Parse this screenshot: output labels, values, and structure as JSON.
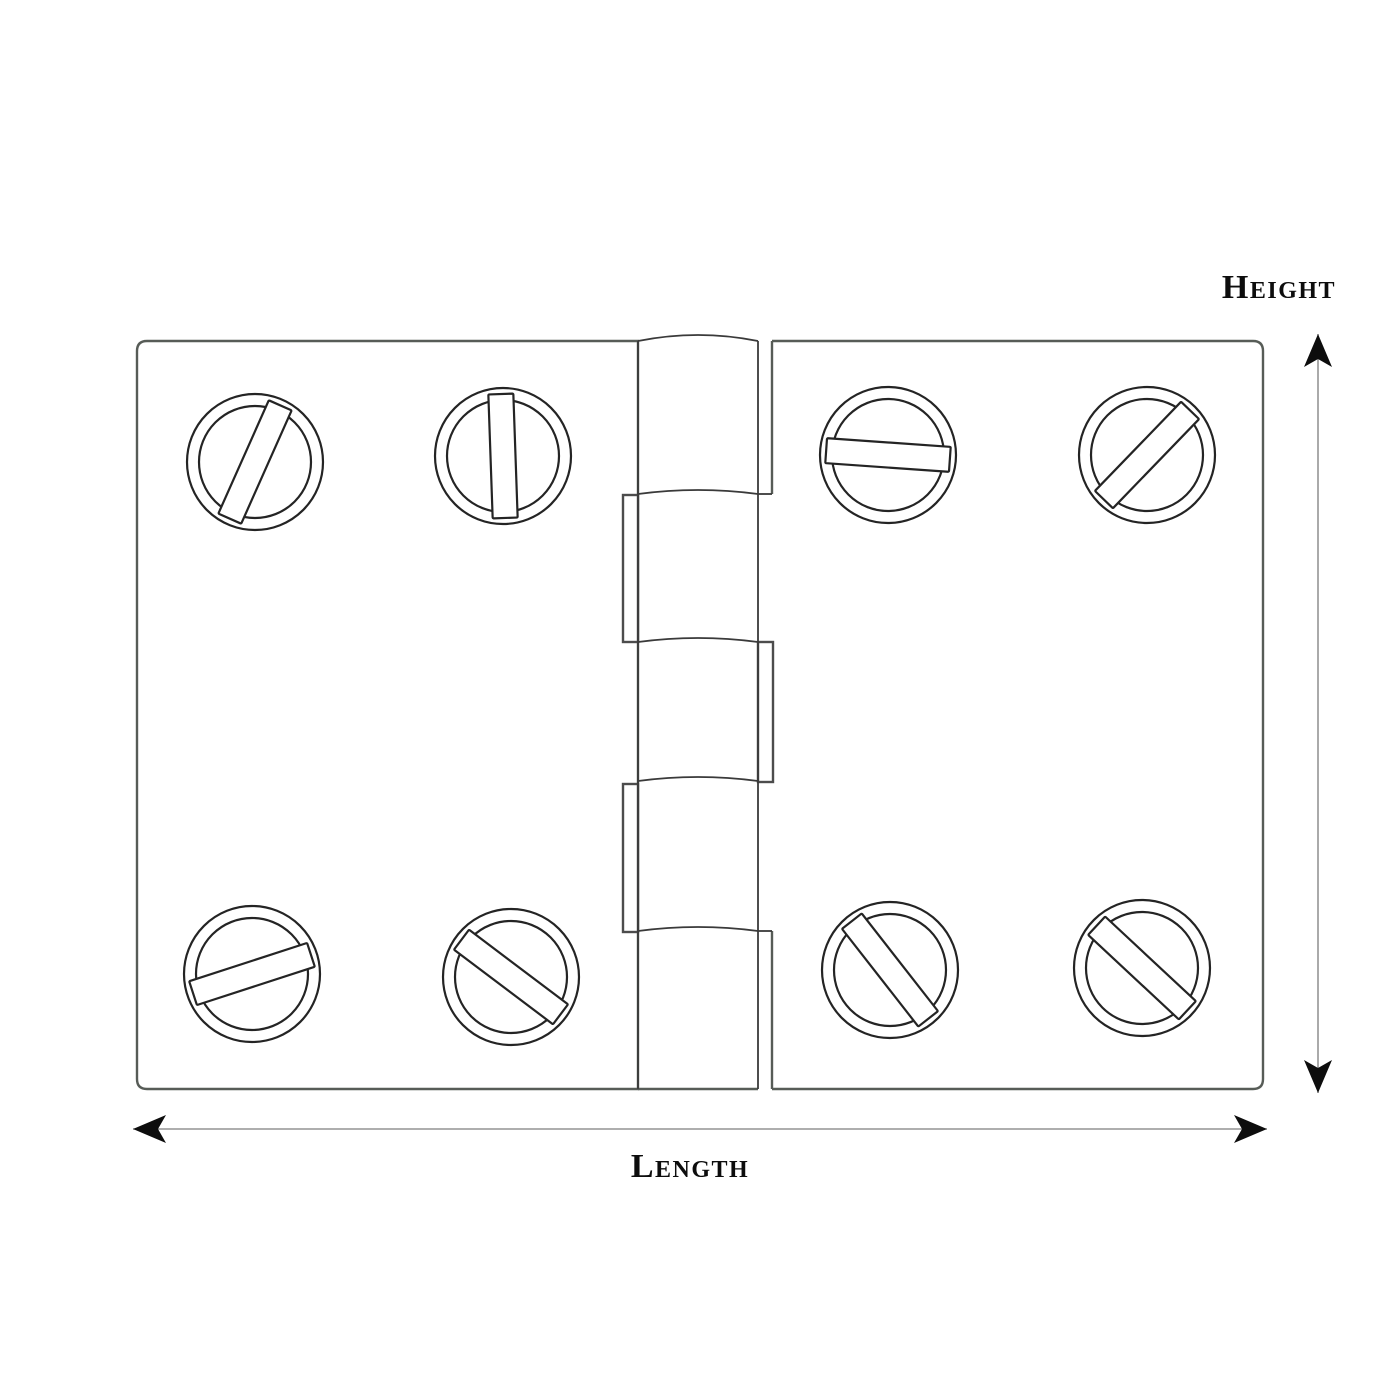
{
  "labels": {
    "height": "Height",
    "length": "Length"
  },
  "colors": {
    "background": "#ffffff",
    "plate_stroke": "#575c57",
    "barrel_stroke": "#3a3a3a",
    "tab_stroke": "#4c4c4c",
    "screw_stroke": "#242424",
    "dim_line": "#7d7d7d",
    "arrow_fill": "#0d0d0d",
    "text": "#0d0d0d",
    "fill": "#ffffff"
  },
  "diagram": {
    "canvas": {
      "w": 1400,
      "h": 1400
    },
    "left_plate": {
      "x1": 137,
      "y1": 341,
      "x2": 638,
      "y2": 1089,
      "corner_r": 10
    },
    "right_plate": {
      "x1": 772,
      "y1": 341,
      "x2": 1263,
      "y2": 1089,
      "corner_r": 10,
      "left_edge_segments": [
        [
          341,
          494
        ],
        [
          931,
          1089
        ]
      ],
      "step_connectors_y": [
        494,
        931
      ]
    },
    "barrel": {
      "x1": 638,
      "x2": 758,
      "top": 341,
      "bottom": 1089,
      "top_arch_ctrl_rise": 12,
      "joints": [
        494,
        642,
        781,
        931
      ],
      "joint_ctrl_rise": 8,
      "tabs": [
        {
          "x": 623,
          "y": 495,
          "w": 15,
          "h": 147
        },
        {
          "x": 623,
          "y": 784,
          "w": 15,
          "h": 148
        },
        {
          "x": 758,
          "y": 642,
          "w": 15,
          "h": 140
        }
      ]
    },
    "screws": {
      "outer_r": 68,
      "inner_r": 56,
      "slot_length": 124,
      "slot_width": 25,
      "items": [
        {
          "x": 255,
          "y": 462,
          "angle": 66
        },
        {
          "x": 503,
          "y": 456,
          "angle": 92
        },
        {
          "x": 888,
          "y": 455,
          "angle": -4
        },
        {
          "x": 1147,
          "y": 455,
          "angle": 46
        },
        {
          "x": 252,
          "y": 974,
          "angle": 18
        },
        {
          "x": 511,
          "y": 977,
          "angle": -37
        },
        {
          "x": 890,
          "y": 970,
          "angle": -52
        },
        {
          "x": 1142,
          "y": 968,
          "angle": -43
        }
      ]
    },
    "dimensions": {
      "length": {
        "y": 1129,
        "x1": 133,
        "x2": 1267,
        "label_x": 690,
        "label_y": 1177
      },
      "height": {
        "x": 1318,
        "y1": 334,
        "y2": 1093,
        "label_x": 1279,
        "label_y": 298
      },
      "arrow_length": 33,
      "arrow_halfwidth": 14,
      "arrow_notch": 8
    },
    "stroke_widths": {
      "plate": 2.4,
      "barrel": 1.8,
      "tab": 2.4,
      "screw": 2.2,
      "dim": 1.3
    }
  }
}
